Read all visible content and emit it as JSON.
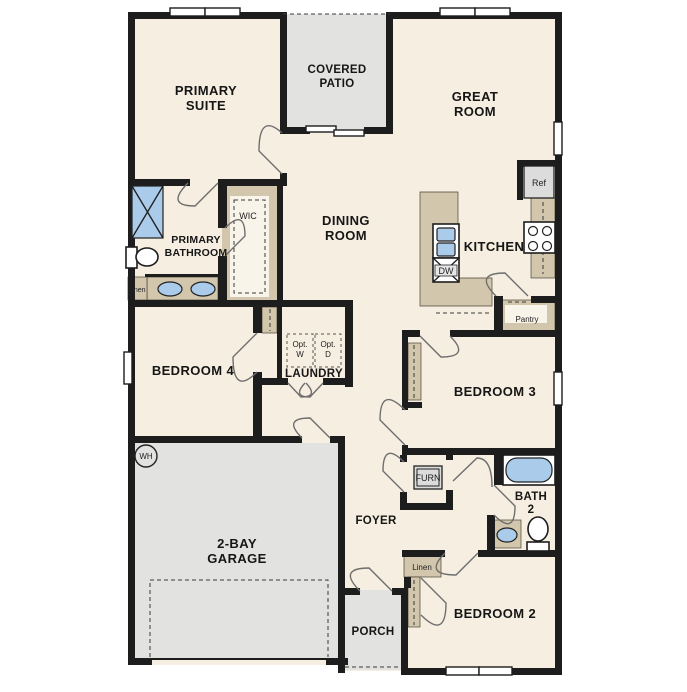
{
  "plan_type": "single-story floor plan",
  "colors": {
    "floor_cream": "#f6eee1",
    "hard_surface_gray": "#e2e2e0",
    "wall_black": "#1d1d1d",
    "cabinet_tan": "#d2c6ac",
    "fixture_blue": "#aacbe9",
    "appliance_gray": "#dcdcdc"
  },
  "rooms": {
    "primary_suite": {
      "l1": "PRIMARY",
      "l2": "SUITE"
    },
    "covered_patio": {
      "l1": "COVERED",
      "l2": "PATIO"
    },
    "great_room": {
      "l1": "GREAT",
      "l2": "ROOM"
    },
    "dining_room": {
      "l1": "DINING",
      "l2": "ROOM"
    },
    "kitchen": {
      "l1": "KITCHEN"
    },
    "primary_bathroom": {
      "l1": "PRIMARY",
      "l2": "BATHROOM"
    },
    "wic": {
      "l1": "WIC"
    },
    "bedroom4": {
      "l1": "BEDROOM 4"
    },
    "laundry": {
      "l1": "LAUNDRY"
    },
    "bedroom3": {
      "l1": "BEDROOM 3"
    },
    "garage": {
      "l1": "2-BAY",
      "l2": "GARAGE"
    },
    "foyer": {
      "l1": "FOYER"
    },
    "bath2": {
      "l1": "BATH",
      "l2": "2"
    },
    "bedroom2": {
      "l1": "BEDROOM 2"
    },
    "porch": {
      "l1": "PORCH"
    }
  },
  "fixtures": {
    "ref": "Ref",
    "dw": "DW",
    "pantry": "Pantry",
    "linen_bath": "Linen",
    "linen_hall": "Linen",
    "opt_washer": {
      "l1": "Opt.",
      "l2": "W"
    },
    "opt_dryer": {
      "l1": "Opt.",
      "l2": "D"
    },
    "furnace": "FURN",
    "water_heater": "WH"
  }
}
